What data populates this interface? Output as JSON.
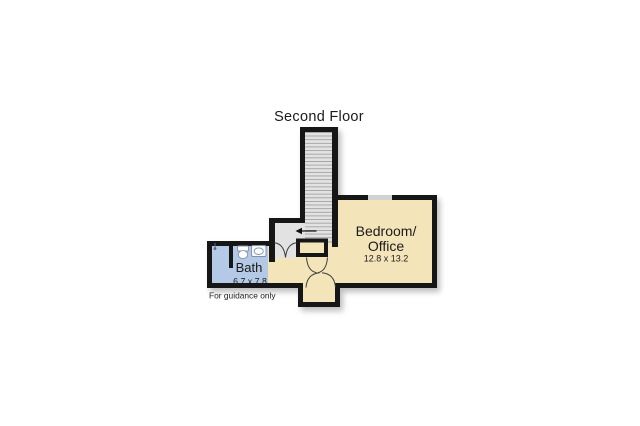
{
  "title": "Second Floor",
  "footer_note": "For guidance only",
  "rooms": {
    "bedroom_office": {
      "name_line1": "Bedroom/",
      "name_line2": "Office",
      "dimensions": "12.8 x 13.2"
    },
    "bath": {
      "name": "Bath",
      "dimensions": "6.7 x 7.8"
    },
    "stairs": {
      "direction_arrow": "left"
    }
  },
  "colors": {
    "background": "#ffffff",
    "wall": "#161616",
    "bedroom_fill": "#f4e4ba",
    "bath_fill": "#b3c9e6",
    "stairs_fill": "#e2e2e2",
    "step_line": "#9a9a9a",
    "window_fill": "#d2d2d2",
    "door_arc": "#3d3d3d",
    "fixture_stroke": "#8191a8",
    "text": "#1b1b1b"
  }
}
